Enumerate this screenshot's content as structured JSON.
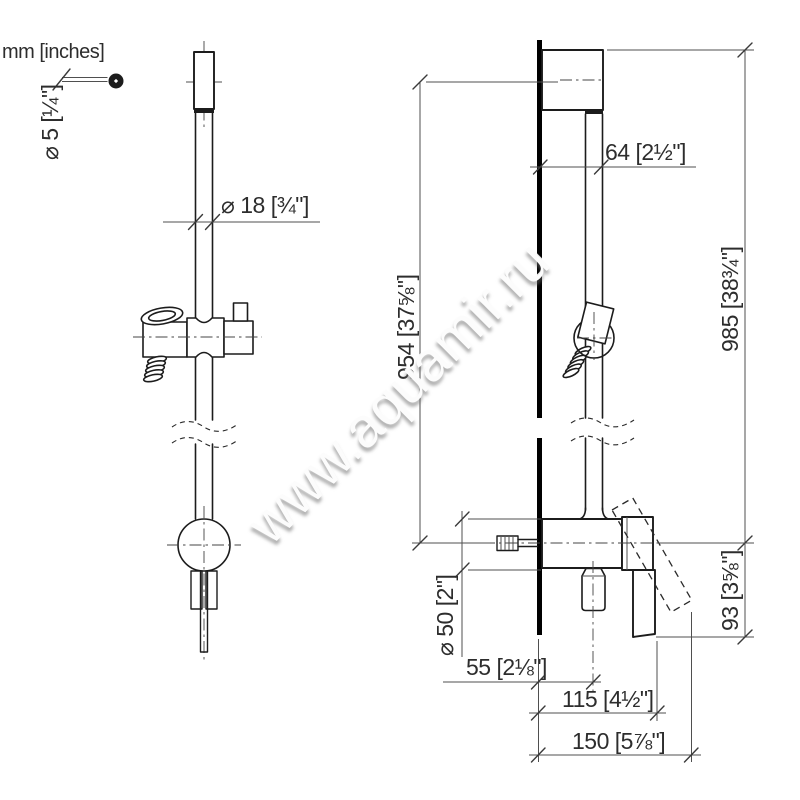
{
  "units_label": "mm [inches]",
  "watermark": "www.aquamir.ru",
  "dimensions": {
    "handle_screw_diameter": "⌀ 5 [¼\"]",
    "rail_diameter": "⌀ 18 [¾\"]",
    "wall_to_rail_center": "64 [2½\"]",
    "rail_fixing_height": "954 [37⅝\"]",
    "overall_height": "985 [38¾\"]",
    "lever_below_center": "93 [3⅝\"]",
    "escutcheon_diameter": "⌀ 50 [2\"]",
    "wall_to_outlet": "55 [2⅛\"]",
    "wall_to_lever": "115 [4½\"]",
    "max_projection": "150 [5⅞\"]"
  }
}
